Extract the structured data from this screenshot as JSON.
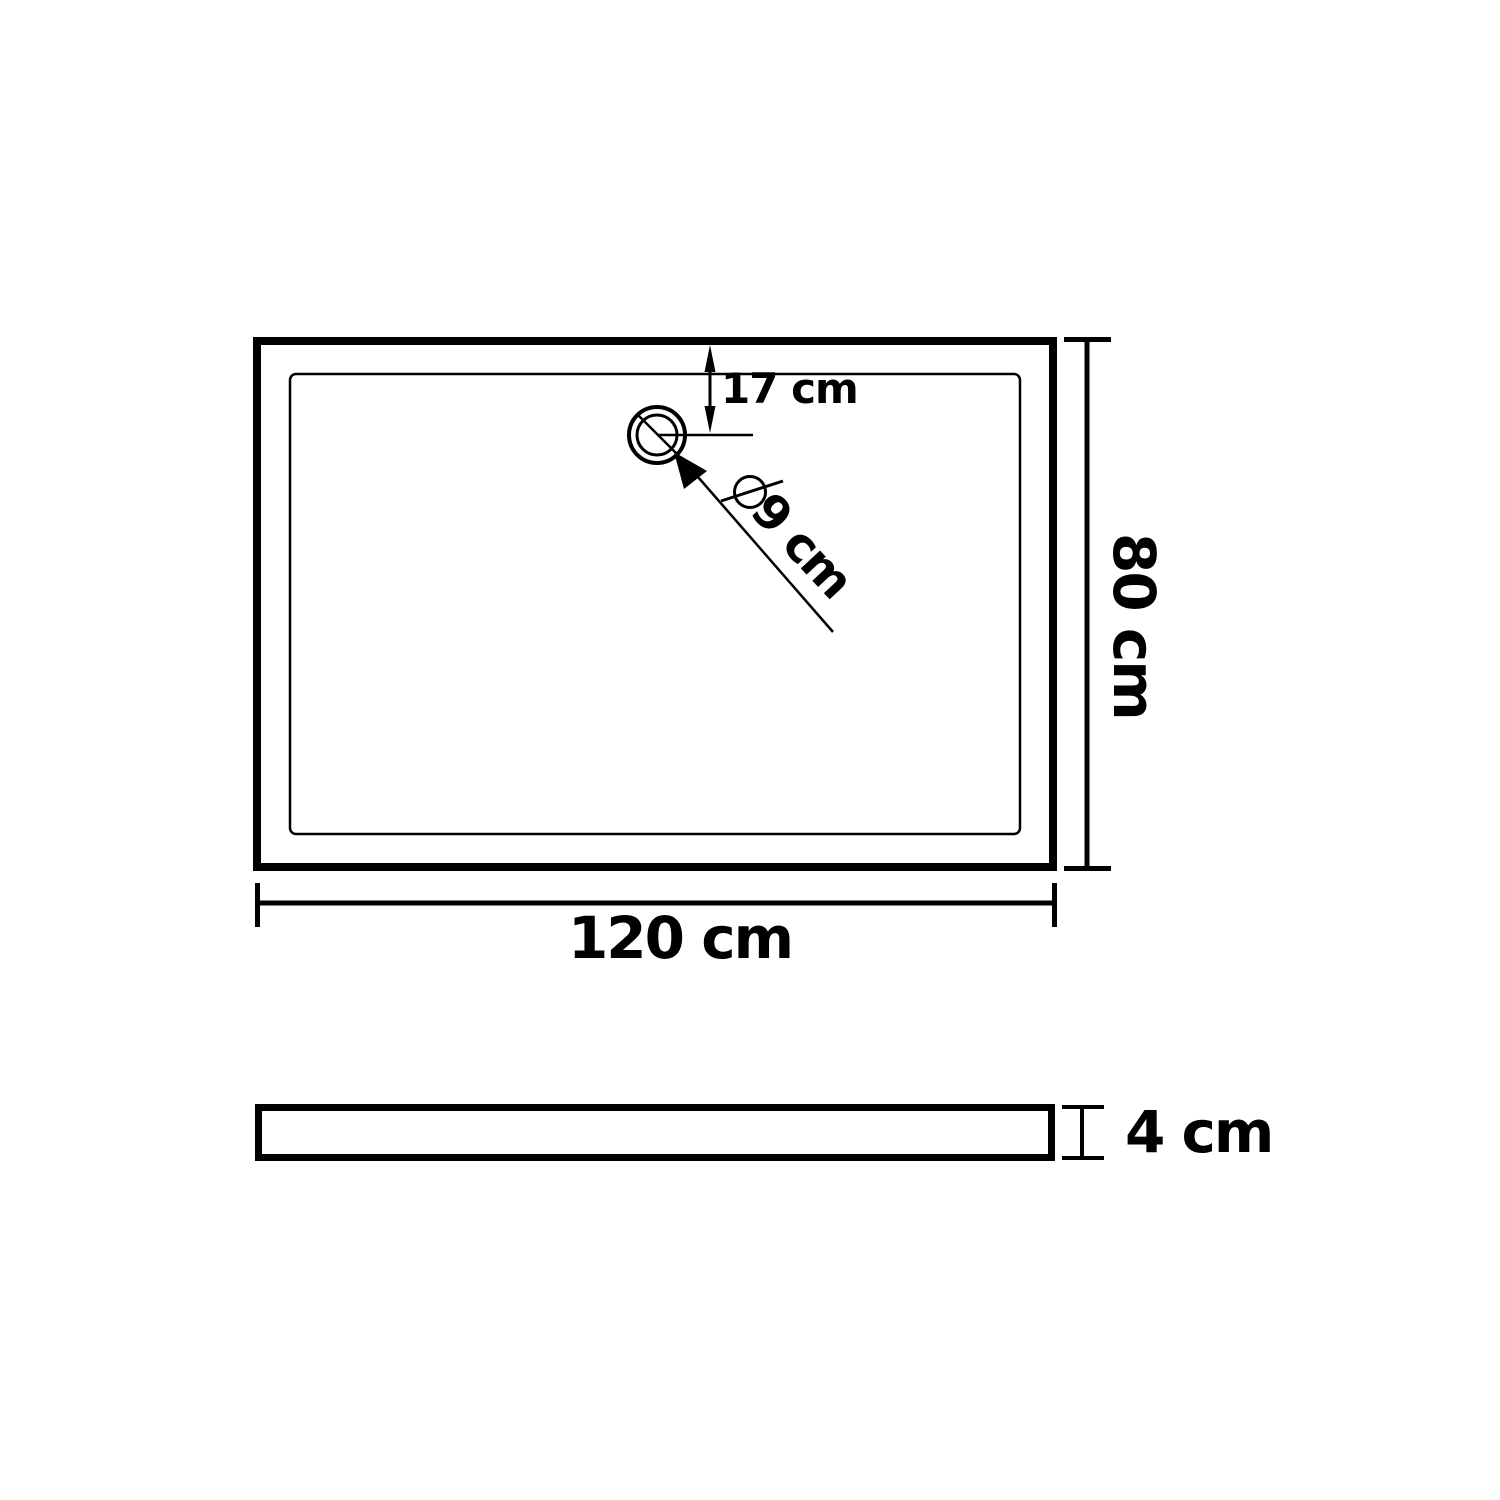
{
  "colors": {
    "line": "#000000",
    "background": "#ffffff"
  },
  "top_view": {
    "name": "shower tray top view",
    "width_label": "120 cm",
    "depth_label": "80 cm",
    "drain_offset_label": "17 cm",
    "drain_diameter_label": "9 cm"
  },
  "side_view": {
    "name": "shower tray side view",
    "thickness_label": "4 cm"
  }
}
